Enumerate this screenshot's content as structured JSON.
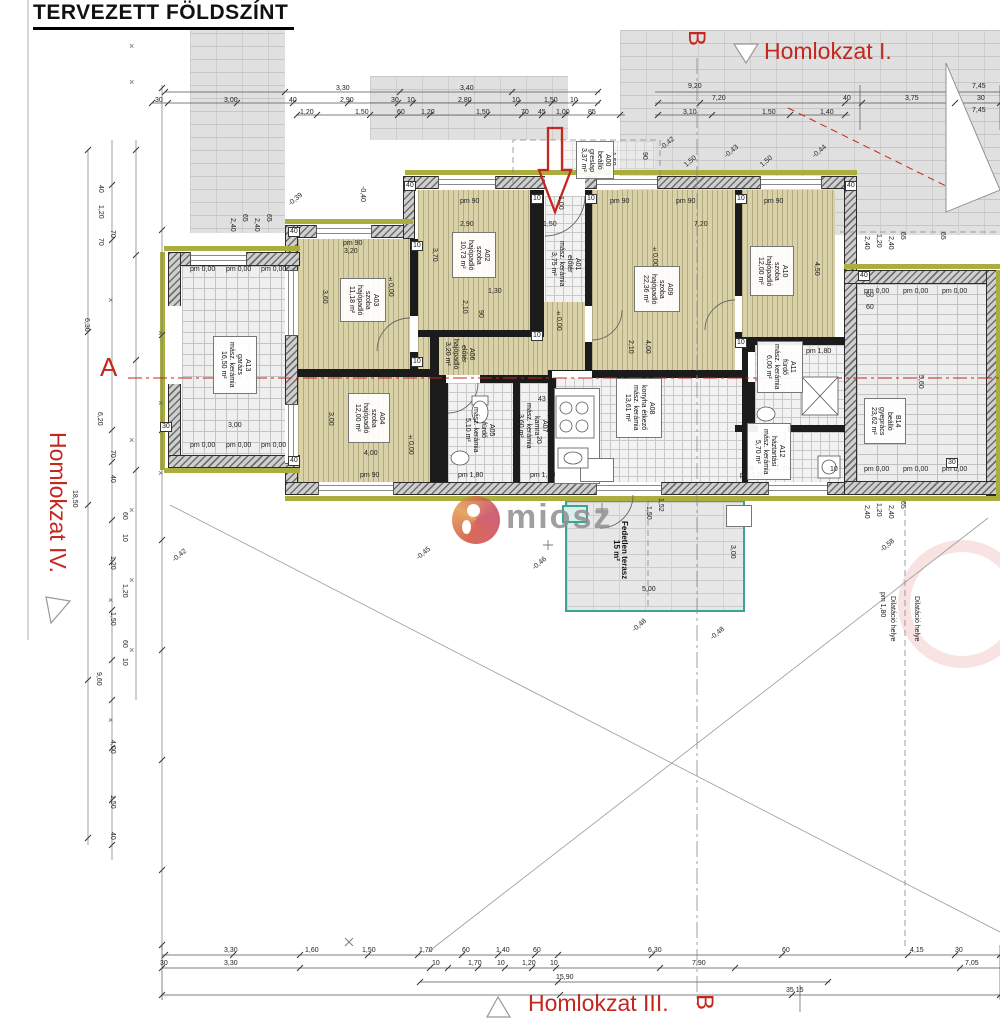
{
  "title": "TERVEZETT FÖLDSZÍNT",
  "watermark": {
    "text": "miosz"
  },
  "markers": {
    "homlokzat_i": "Homlokzat I.",
    "homlokzat_iii": "Homlokzat III.",
    "homlokzat_iv": "Homlokzat IV.",
    "section_a": "A",
    "section_b_top": "B",
    "section_b_bottom": "B"
  },
  "colors": {
    "annotation_red": "#c4271e",
    "terrace_teal": "#3aa49b",
    "insulation_olive": "#a9ae3f",
    "wood_floor_tan": "#d8d1a8"
  },
  "rooms": [
    {
      "id": "A00",
      "lines": [
        "A00",
        "beálló",
        "greslap",
        "3,37 m²"
      ],
      "x": 576,
      "y": 141,
      "w": 38,
      "h": 38,
      "box": true
    },
    {
      "id": "A01",
      "lines": [
        "A01",
        "előtér",
        "mász. kerámia",
        "3,75 m²"
      ],
      "x": 552,
      "y": 240,
      "w": 26,
      "h": 48,
      "box": false
    },
    {
      "id": "A02",
      "lines": [
        "A02",
        "szoba",
        "hajópadló",
        "10,73 m²"
      ],
      "x": 452,
      "y": 232,
      "w": 44,
      "h": 46,
      "box": true
    },
    {
      "id": "A03",
      "lines": [
        "A03",
        "szoba",
        "hajópadló",
        "11,18 m²"
      ],
      "x": 340,
      "y": 278,
      "w": 46,
      "h": 44,
      "box": true
    },
    {
      "id": "A04",
      "lines": [
        "A04",
        "szoba",
        "hajópadló",
        "12,00 m²"
      ],
      "x": 348,
      "y": 393,
      "w": 42,
      "h": 50,
      "box": true
    },
    {
      "id": "A05",
      "lines": [
        "A05",
        "fürdő",
        "mász. kerámia",
        "5,10 m²"
      ],
      "x": 463,
      "y": 402,
      "w": 32,
      "h": 56,
      "box": false
    },
    {
      "id": "A06",
      "lines": [
        "A06",
        "előtér",
        "hajópadló",
        "3,20 m²"
      ],
      "x": 446,
      "y": 331,
      "w": 26,
      "h": 46,
      "box": false
    },
    {
      "id": "A07",
      "lines": [
        "A07",
        "kamra",
        "mász. kerámia",
        "3,60 m²"
      ],
      "x": 518,
      "y": 396,
      "w": 28,
      "h": 60,
      "box": false
    },
    {
      "id": "A08",
      "lines": [
        "A08",
        "konyha étkező",
        "mász. kerámia",
        "13,61 m²"
      ],
      "x": 616,
      "y": 378,
      "w": 46,
      "h": 60,
      "box": true
    },
    {
      "id": "A09",
      "lines": [
        "A09",
        "szoba",
        "hajópadló",
        "22,36 m²"
      ],
      "x": 634,
      "y": 266,
      "w": 46,
      "h": 46,
      "box": true
    },
    {
      "id": "A10",
      "lines": [
        "A10",
        "szoba",
        "hajópadló",
        "12,00 m²"
      ],
      "x": 750,
      "y": 246,
      "w": 44,
      "h": 50,
      "box": true
    },
    {
      "id": "A11",
      "lines": [
        "A11",
        "fürdő",
        "mász. kerámia",
        "6,00 m²"
      ],
      "x": 757,
      "y": 341,
      "w": 46,
      "h": 52,
      "box": true
    },
    {
      "id": "A12",
      "lines": [
        "A12",
        "háztartási",
        "mász. kerámia",
        "5,70 m²"
      ],
      "x": 747,
      "y": 423,
      "w": 44,
      "h": 57,
      "box": true
    },
    {
      "id": "A13",
      "lines": [
        "A13",
        "garázs",
        "mász. kerámia",
        "16,50 m²"
      ],
      "x": 213,
      "y": 336,
      "w": 44,
      "h": 58,
      "box": true
    },
    {
      "id": "B14",
      "lines": [
        "B14",
        "beálló",
        "gyeprács",
        "23,62 m²"
      ],
      "x": 864,
      "y": 398,
      "w": 42,
      "h": 46,
      "box": true
    },
    {
      "id": "TERASZ",
      "lines": [
        "Fedetlen terasz",
        "15 m²"
      ],
      "x": 598,
      "y": 515,
      "w": 44,
      "h": 70,
      "box": false,
      "bold": true
    }
  ],
  "dims": [
    {
      "t": "3,30",
      "x": 336,
      "y": 85
    },
    {
      "t": "3,40",
      "x": 460,
      "y": 85
    },
    {
      "t": "30",
      "x": 155,
      "y": 97
    },
    {
      "t": "3,00",
      "x": 224,
      "y": 97
    },
    {
      "t": "40",
      "x": 289,
      "y": 97
    },
    {
      "t": "2,90",
      "x": 340,
      "y": 97
    },
    {
      "t": "30",
      "x": 391,
      "y": 97
    },
    {
      "t": "10",
      "x": 407,
      "y": 97
    },
    {
      "t": "2,80",
      "x": 458,
      "y": 97
    },
    {
      "t": "10",
      "x": 512,
      "y": 97
    },
    {
      "t": "1,50",
      "x": 544,
      "y": 97
    },
    {
      "t": "10",
      "x": 570,
      "y": 97
    },
    {
      "t": "1,20",
      "x": 300,
      "y": 109
    },
    {
      "t": "1,50",
      "x": 355,
      "y": 109
    },
    {
      "t": "60",
      "x": 397,
      "y": 109
    },
    {
      "t": "1,20",
      "x": 421,
      "y": 109
    },
    {
      "t": "1,50",
      "x": 476,
      "y": 109
    },
    {
      "t": "70",
      "x": 521,
      "y": 109
    },
    {
      "t": "45",
      "x": 538,
      "y": 109
    },
    {
      "t": "1,00",
      "x": 556,
      "y": 109
    },
    {
      "t": "85",
      "x": 588,
      "y": 109
    },
    {
      "t": "9,20",
      "x": 688,
      "y": 83
    },
    {
      "t": "7,20",
      "x": 712,
      "y": 95
    },
    {
      "t": "3,10",
      "x": 683,
      "y": 109
    },
    {
      "t": "1,50",
      "x": 762,
      "y": 109
    },
    {
      "t": "1,40",
      "x": 820,
      "y": 109
    },
    {
      "t": "40",
      "x": 843,
      "y": 95
    },
    {
      "t": "3,75",
      "x": 905,
      "y": 95
    },
    {
      "t": "7,45",
      "x": 972,
      "y": 83
    },
    {
      "t": "30",
      "x": 977,
      "y": 95
    },
    {
      "t": "7,45",
      "x": 972,
      "y": 107
    },
    {
      "t": "3,30",
      "x": 224,
      "y": 947
    },
    {
      "t": "1,60",
      "x": 305,
      "y": 947
    },
    {
      "t": "1,50",
      "x": 362,
      "y": 947
    },
    {
      "t": "1,70",
      "x": 419,
      "y": 947
    },
    {
      "t": "60",
      "x": 462,
      "y": 947
    },
    {
      "t": "1,40",
      "x": 496,
      "y": 947
    },
    {
      "t": "60",
      "x": 533,
      "y": 947
    },
    {
      "t": "6,30",
      "x": 648,
      "y": 947
    },
    {
      "t": "60",
      "x": 782,
      "y": 947
    },
    {
      "t": "4,15",
      "x": 910,
      "y": 947
    },
    {
      "t": "30",
      "x": 955,
      "y": 947
    },
    {
      "t": "30",
      "x": 160,
      "y": 960
    },
    {
      "t": "3,30",
      "x": 224,
      "y": 960
    },
    {
      "t": "10",
      "x": 432,
      "y": 960
    },
    {
      "t": "1,70",
      "x": 468,
      "y": 960
    },
    {
      "t": "10",
      "x": 497,
      "y": 960
    },
    {
      "t": "1,20",
      "x": 522,
      "y": 960
    },
    {
      "t": "10",
      "x": 550,
      "y": 960
    },
    {
      "t": "7,90",
      "x": 692,
      "y": 960
    },
    {
      "t": "7,05",
      "x": 965,
      "y": 960
    },
    {
      "t": "15,90",
      "x": 556,
      "y": 974
    },
    {
      "t": "35,15",
      "x": 786,
      "y": 987
    },
    {
      "t": "40",
      "x": 96,
      "y": 185,
      "r": 1
    },
    {
      "t": "1,20",
      "x": 96,
      "y": 205,
      "r": 1
    },
    {
      "t": "70",
      "x": 96,
      "y": 238,
      "r": 1
    },
    {
      "t": "70",
      "x": 108,
      "y": 230,
      "r": 1
    },
    {
      "t": "6,30",
      "x": 82,
      "y": 318,
      "r": 1
    },
    {
      "t": "6,20",
      "x": 95,
      "y": 412,
      "r": 1
    },
    {
      "t": "18,50",
      "x": 70,
      "y": 490,
      "r": 1
    },
    {
      "t": "70",
      "x": 108,
      "y": 450,
      "r": 1
    },
    {
      "t": "40",
      "x": 108,
      "y": 475,
      "r": 1
    },
    {
      "t": "60",
      "x": 120,
      "y": 512,
      "r": 1
    },
    {
      "t": "10",
      "x": 120,
      "y": 534,
      "r": 1
    },
    {
      "t": "1,20",
      "x": 108,
      "y": 556,
      "r": 1
    },
    {
      "t": "1,20",
      "x": 120,
      "y": 584,
      "r": 1
    },
    {
      "t": "1,50",
      "x": 108,
      "y": 612,
      "r": 1
    },
    {
      "t": "60",
      "x": 120,
      "y": 640,
      "r": 1
    },
    {
      "t": "10",
      "x": 120,
      "y": 658,
      "r": 1
    },
    {
      "t": "9,60",
      "x": 94,
      "y": 672,
      "r": 1
    },
    {
      "t": "4,00",
      "x": 108,
      "y": 740,
      "r": 1
    },
    {
      "t": "1,50",
      "x": 108,
      "y": 795,
      "r": 1
    },
    {
      "t": "40",
      "x": 108,
      "y": 832,
      "r": 1
    },
    {
      "t": "2,40",
      "x": 228,
      "y": 218,
      "r": 1
    },
    {
      "t": "65",
      "x": 240,
      "y": 214,
      "r": 1
    },
    {
      "t": "2,40",
      "x": 252,
      "y": 218,
      "r": 1
    },
    {
      "t": "65",
      "x": 264,
      "y": 214,
      "r": 1
    },
    {
      "t": "2,40",
      "x": 862,
      "y": 236,
      "r": 1
    },
    {
      "t": "1,20",
      "x": 874,
      "y": 234,
      "r": 1
    },
    {
      "t": "2,40",
      "x": 886,
      "y": 236,
      "r": 1
    },
    {
      "t": "65",
      "x": 898,
      "y": 232,
      "r": 1
    },
    {
      "t": "65",
      "x": 938,
      "y": 232,
      "r": 1
    },
    {
      "t": "2,40",
      "x": 862,
      "y": 505,
      "r": 1
    },
    {
      "t": "1,20",
      "x": 874,
      "y": 503,
      "r": 1
    },
    {
      "t": "2,40",
      "x": 886,
      "y": 505,
      "r": 1
    },
    {
      "t": "65",
      "x": 898,
      "y": 501,
      "r": 1
    },
    {
      "t": "pm 0,00",
      "x": 190,
      "y": 266
    },
    {
      "t": "pm 0,00",
      "x": 226,
      "y": 266
    },
    {
      "t": "pm 0,00",
      "x": 261,
      "y": 266
    },
    {
      "t": "pm 0,00",
      "x": 190,
      "y": 442
    },
    {
      "t": "pm 0,00",
      "x": 226,
      "y": 442
    },
    {
      "t": "pm 0,00",
      "x": 261,
      "y": 442
    },
    {
      "t": "pm 0,00",
      "x": 864,
      "y": 288
    },
    {
      "t": "pm 0,00",
      "x": 903,
      "y": 288
    },
    {
      "t": "pm 0,00",
      "x": 942,
      "y": 288
    },
    {
      "t": "pm 0,00",
      "x": 864,
      "y": 466
    },
    {
      "t": "pm 0,00",
      "x": 903,
      "y": 466
    },
    {
      "t": "pm 0,00",
      "x": 942,
      "y": 466
    },
    {
      "t": "pm 90",
      "x": 343,
      "y": 240
    },
    {
      "t": "pm 90",
      "x": 460,
      "y": 198
    },
    {
      "t": "pm 90",
      "x": 610,
      "y": 198
    },
    {
      "t": "pm 90",
      "x": 676,
      "y": 198
    },
    {
      "t": "pm 90",
      "x": 764,
      "y": 198
    },
    {
      "t": "pm 90",
      "x": 360,
      "y": 472
    },
    {
      "t": "pm 1,80",
      "x": 458,
      "y": 472
    },
    {
      "t": "pm 1,80",
      "x": 530,
      "y": 472
    },
    {
      "t": "pm 1,80",
      "x": 740,
      "y": 472
    },
    {
      "t": "pm 1,80",
      "x": 806,
      "y": 348
    },
    {
      "t": "pm 1,80",
      "x": 878,
      "y": 592,
      "r": 1
    },
    {
      "t": "3,20",
      "x": 344,
      "y": 248
    },
    {
      "t": "2,90",
      "x": 460,
      "y": 221
    },
    {
      "t": "7,20",
      "x": 694,
      "y": 221
    },
    {
      "t": "3,60",
      "x": 320,
      "y": 290,
      "r": 1
    },
    {
      "t": "3,70",
      "x": 430,
      "y": 248,
      "r": 1
    },
    {
      "t": "4,50",
      "x": 812,
      "y": 262,
      "r": 1
    },
    {
      "t": "±0,00",
      "x": 386,
      "y": 276,
      "r": 1
    },
    {
      "t": "±0,00",
      "x": 650,
      "y": 246,
      "r": 1
    },
    {
      "t": "±0,00",
      "x": 406,
      "y": 434,
      "r": 1
    },
    {
      "t": "±0,00",
      "x": 545,
      "y": 404,
      "r": 1
    },
    {
      "t": "±0,00",
      "x": 554,
      "y": 310,
      "r": 1
    },
    {
      "t": "3,00",
      "x": 326,
      "y": 412,
      "r": 1
    },
    {
      "t": "4,00",
      "x": 364,
      "y": 450
    },
    {
      "t": "3,00",
      "x": 228,
      "y": 422
    },
    {
      "t": "2,10",
      "x": 460,
      "y": 300,
      "r": 1
    },
    {
      "t": "1,30",
      "x": 488,
      "y": 288
    },
    {
      "t": "90",
      "x": 476,
      "y": 310,
      "r": 1
    },
    {
      "t": "2,10",
      "x": 626,
      "y": 340,
      "r": 1
    },
    {
      "t": "4,00",
      "x": 643,
      "y": 340,
      "r": 1
    },
    {
      "t": "1,50",
      "x": 543,
      "y": 221
    },
    {
      "t": "1,00",
      "x": 556,
      "y": 196,
      "r": 1
    },
    {
      "t": "2,10",
      "x": 740,
      "y": 352,
      "r": 1
    },
    {
      "t": "10",
      "x": 746,
      "y": 466
    },
    {
      "t": "1,70",
      "x": 776,
      "y": 466
    },
    {
      "t": "10",
      "x": 830,
      "y": 466
    },
    {
      "t": "5,60",
      "x": 916,
      "y": 375,
      "r": 1
    },
    {
      "t": "60",
      "x": 866,
      "y": 292
    },
    {
      "t": "60",
      "x": 866,
      "y": 304
    },
    {
      "t": "43",
      "x": 538,
      "y": 396
    },
    {
      "t": "20",
      "x": 534,
      "y": 436,
      "r": 1
    },
    {
      "t": "1,52",
      "x": 656,
      "y": 498,
      "r": 1
    },
    {
      "t": "1,50",
      "x": 644,
      "y": 506,
      "r": 1
    },
    {
      "t": "5,00",
      "x": 642,
      "y": 586
    },
    {
      "t": "3,00",
      "x": 728,
      "y": 545,
      "r": 1
    },
    {
      "t": "40",
      "x": 288,
      "y": 227,
      "b": 1
    },
    {
      "t": "40",
      "x": 288,
      "y": 456,
      "b": 1
    },
    {
      "t": "40",
      "x": 404,
      "y": 181,
      "b": 1
    },
    {
      "t": "10",
      "x": 411,
      "y": 241,
      "b": 1
    },
    {
      "t": "10",
      "x": 411,
      "y": 357,
      "b": 1
    },
    {
      "t": "10",
      "x": 531,
      "y": 194,
      "b": 1
    },
    {
      "t": "10",
      "x": 531,
      "y": 331,
      "b": 1
    },
    {
      "t": "10",
      "x": 585,
      "y": 194,
      "b": 1
    },
    {
      "t": "10",
      "x": 735,
      "y": 194,
      "b": 1
    },
    {
      "t": "10",
      "x": 735,
      "y": 338,
      "b": 1
    },
    {
      "t": "40",
      "x": 845,
      "y": 181,
      "b": 1
    },
    {
      "t": "40",
      "x": 858,
      "y": 271,
      "b": 1
    },
    {
      "t": "30",
      "x": 946,
      "y": 458,
      "b": 1
    },
    {
      "t": "30",
      "x": 160,
      "y": 422,
      "b": 1
    },
    {
      "t": "-0,39",
      "x": 288,
      "y": 196,
      "r": 3
    },
    {
      "t": "-0,40",
      "x": 358,
      "y": 186,
      "r": 1
    },
    {
      "t": "-0,42",
      "x": 660,
      "y": 140,
      "r": 3
    },
    {
      "t": "-0,43",
      "x": 724,
      "y": 148,
      "r": 3
    },
    {
      "t": "-0,44",
      "x": 812,
      "y": 148,
      "r": 3
    },
    {
      "t": "1,50",
      "x": 684,
      "y": 158,
      "r": 3
    },
    {
      "t": "1,50",
      "x": 760,
      "y": 158,
      "r": 3
    },
    {
      "t": "1,50",
      "x": 608,
      "y": 152,
      "r": 1
    },
    {
      "t": "90",
      "x": 640,
      "y": 152,
      "r": 1
    },
    {
      "t": "-0,45",
      "x": 416,
      "y": 550,
      "r": 3
    },
    {
      "t": "-0,46",
      "x": 532,
      "y": 560,
      "r": 3
    },
    {
      "t": "-0,48",
      "x": 632,
      "y": 622,
      "r": 3
    },
    {
      "t": "-0,48",
      "x": 710,
      "y": 630,
      "r": 3
    },
    {
      "t": "-0,58",
      "x": 880,
      "y": 542,
      "r": 3
    },
    {
      "t": "-0,42",
      "x": 172,
      "y": 552,
      "r": 3
    },
    {
      "t": "Dilatáció helye",
      "x": 888,
      "y": 596,
      "r": 1
    },
    {
      "t": "Dilatáció helye",
      "x": 912,
      "y": 596,
      "r": 1
    }
  ]
}
